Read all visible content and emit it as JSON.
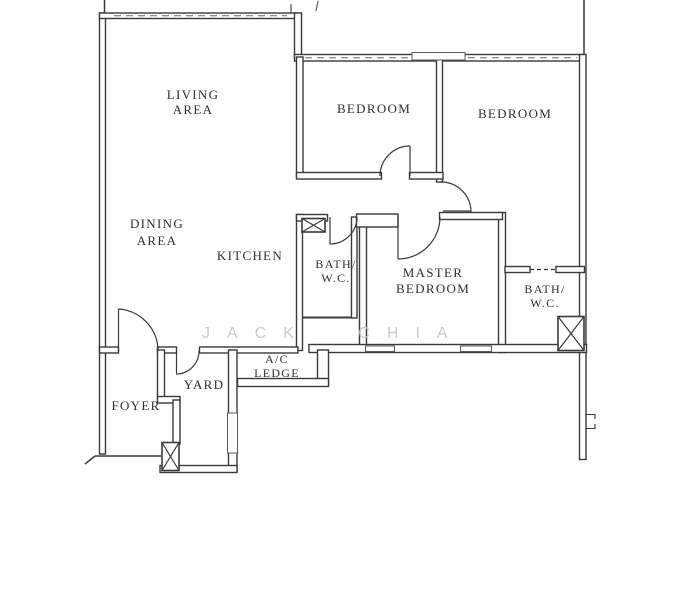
{
  "floorplan": {
    "watermark": "JACK CHIA",
    "labels": {
      "living": [
        "LIVING",
        "AREA"
      ],
      "dining": [
        "DINING",
        "AREA"
      ],
      "kitchen": [
        "KITCHEN"
      ],
      "bedroom1": [
        "BEDROOM"
      ],
      "bedroom2": [
        "BEDROOM"
      ],
      "master": [
        "MASTER",
        "BEDROOM"
      ],
      "bath1": [
        "BATH/",
        "W.C."
      ],
      "bath2": [
        "BATH/",
        "W.C."
      ],
      "ac_ledge": [
        "A/C",
        "LEDGE"
      ],
      "yard": [
        "YARD"
      ],
      "foyer": [
        "FOYER"
      ]
    },
    "colors": {
      "wall": "#3a3a3a",
      "label_text": "#2f2f2f",
      "watermark": "#c9c9c9",
      "background": "#ffffff"
    }
  }
}
